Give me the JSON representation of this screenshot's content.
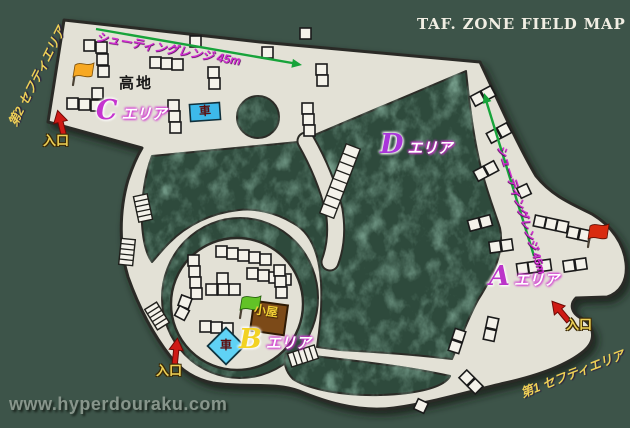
{
  "title": "TAF. ZONE FIELD MAP",
  "watermark": "www.hyperdouraku.com",
  "areas": {
    "a": {
      "letter": "A",
      "suffix": "エリア"
    },
    "b": {
      "letter": "B",
      "suffix": "エリア"
    },
    "c": {
      "letter": "C",
      "suffix": "エリア"
    },
    "d": {
      "letter": "D",
      "suffix": "エリア"
    }
  },
  "labels": {
    "highland": "高地",
    "car": "車",
    "hut": "小屋",
    "entrance": "入口",
    "safety_area_1": "第1 セフティエリア",
    "safety_area_2": "第2 セフティエリア",
    "shooting_range": "シューティングレンジ 45m"
  },
  "markers": {
    "c_area_flag": "orange-flag-icon",
    "b_area_flag": "green-flag-icon",
    "a_area_flag": "red-flag-icon",
    "entrance_marker": "red-arrow-icon",
    "shooting_range_marker": "green-arrow-icon",
    "obstacle_marker": "white-bunker-block",
    "stairs_marker": "stairs-icon",
    "tree_marker": "tree-circle"
  },
  "colors": {
    "bg": "#3d5449",
    "field": "#e3e1d6",
    "field-border": "#2b2b26",
    "zone": "#2e4a3c",
    "bunker": "#f4f2ea",
    "bunker-border": "#1a1a1a",
    "range": "#17a33a",
    "magenta": "#d02fd0",
    "yellow": "#edd056",
    "red": "#cf1a15",
    "title": "#f1eee3",
    "watermark": "#8e9b91",
    "ink": "#161616",
    "letter-a": "#bb35c9",
    "letter-b": "#f2d223",
    "letter-c": "#c535cf",
    "letter-d": "#a935d9",
    "car-blue": "#3db9ea",
    "diamond-blue": "#5fd2f5",
    "hut-brown": "#7c4a18",
    "flag-orange": "#f7a822",
    "flag-green": "#62c227",
    "flag-red": "#d92b10"
  }
}
